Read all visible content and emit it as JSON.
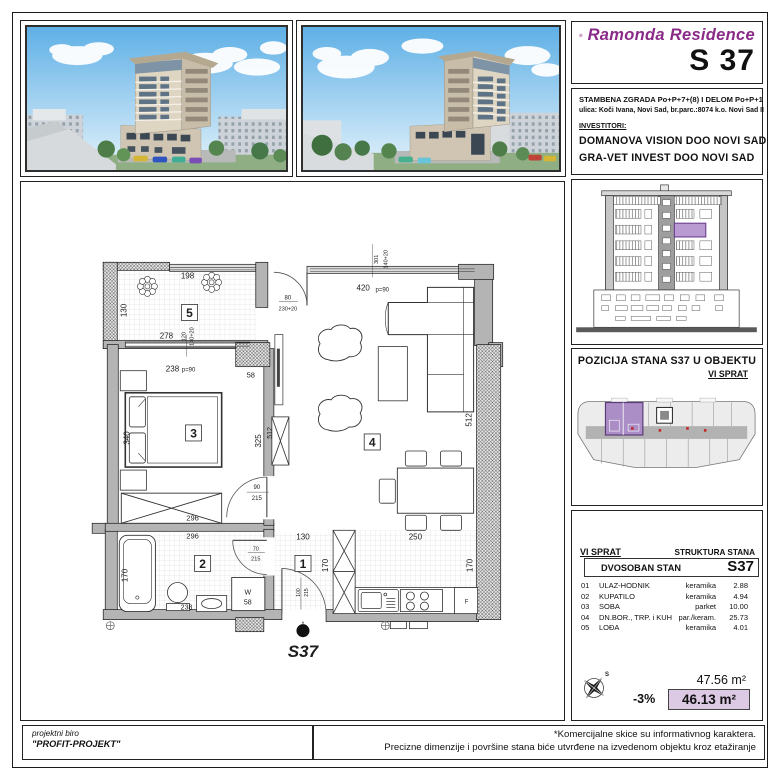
{
  "brand": {
    "name": "Ramonda Residence",
    "unit": "S 37",
    "accent": "#8a2b88"
  },
  "building_info": {
    "line1": "STAMBENA ZGRADA  Po+P+7+(8) I DELOM Po+P+1",
    "line2": "ulica: Koči Ivana, Novi Sad, br.parc.:8074 k.o. Novi Sad II",
    "investors_label": "INVESTITORI:",
    "investor1": "DOMANOVA VISION DOO NOVI SAD",
    "investor2": "GRA-VET INVEST DOO NOVI SAD"
  },
  "position": {
    "title": "POZICIJA STANA  S37  U OBJEKTU",
    "floor": "VI  SPRAT",
    "highlight": "#ab8ec6"
  },
  "table": {
    "floor": "VI  SPRAT",
    "header": "STRUKTURA  STANA",
    "type": "DVOSOBAN STAN",
    "unit": "S37",
    "rows": [
      {
        "num": "01",
        "name": "ULAZ-HODNIK",
        "finish": "keramika",
        "area": "2.88"
      },
      {
        "num": "02",
        "name": "KUPATILO",
        "finish": "keramika",
        "area": "4.94"
      },
      {
        "num": "03",
        "name": "SOBA",
        "finish": "parket",
        "area": "10.00"
      },
      {
        "num": "04",
        "name": "DN.BOR., TRP. i KUH",
        "finish": "par./keram.",
        "area": "25.73"
      },
      {
        "num": "05",
        "name": "LOĐA",
        "finish": "keramika",
        "area": "4.01"
      }
    ]
  },
  "areas": {
    "gross": "47.56 m²",
    "pct": "-3%",
    "net": "46.13 m²",
    "highlight": "#dcc9e4"
  },
  "compass": {
    "north": "S"
  },
  "footer": {
    "left_line1": "projektni biro",
    "left_line2": "\"PROFIT-PROJEKT\"",
    "right_line1": "*Komercijalne skice su informativnog karaktera.",
    "right_line2": "Precizne dimenzije i površine stana biće utvrđene na izvedenom objektu kroz etažiranje"
  },
  "plan": {
    "entrance": "S37",
    "rooms": {
      "hall": "1",
      "bath": "2",
      "bedroom": "3",
      "living": "4",
      "loggia": "5"
    },
    "dims": {
      "v301": "301",
      "v140a": "140+20",
      "w420": "420",
      "p90a": "p=90",
      "d198": "198",
      "d130": "130",
      "d278": "278",
      "v120": "120",
      "v140b": "140+20",
      "d238": "238",
      "p90b": "p=90",
      "d58": "58",
      "d80": "80",
      "d230": "230+20",
      "d340": "340",
      "d325": "325",
      "d512a": "512",
      "d512b": "512",
      "d90": "90",
      "d215a": "215",
      "d296a": "296",
      "d296b": "296",
      "d170a": "170",
      "d238b": "238",
      "d70": "70",
      "d215b": "215",
      "w": "W",
      "w58": "58",
      "d130b": "130",
      "d170b": "170",
      "d100": "100",
      "d215c": "215",
      "d250": "250",
      "d170c": "170",
      "f": "F"
    }
  }
}
